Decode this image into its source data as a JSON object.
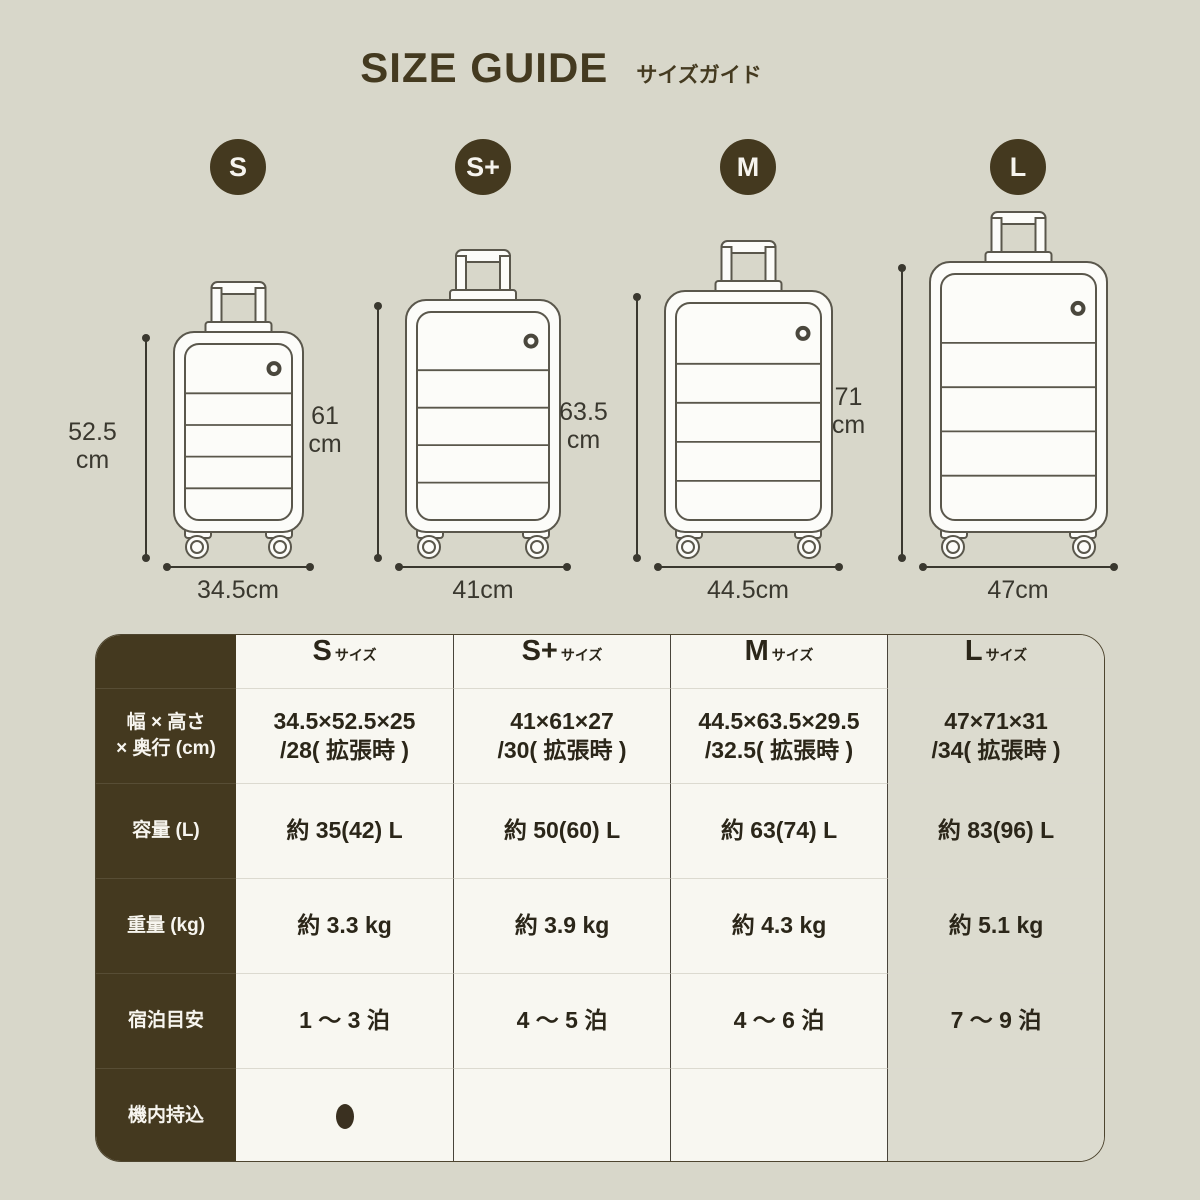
{
  "title": "SIZE GUIDE",
  "subtitle": "サイズガイド",
  "colors": {
    "background": "#d8d7ca",
    "accent_brown": "#44391f",
    "cell_white": "#f8f7f1",
    "cell_l_tint": "#dcdbcf",
    "line": "#3a382f"
  },
  "sizes": [
    {
      "badge": "S",
      "height_value": "52.5",
      "unit": "cm",
      "width_label": "34.5cm",
      "height_cm": 52.5,
      "width_cm": 34.5
    },
    {
      "badge": "S+",
      "height_value": "61",
      "unit": "cm",
      "width_label": "41cm",
      "height_cm": 61,
      "width_cm": 41
    },
    {
      "badge": "M",
      "height_value": "63.5",
      "unit": "cm",
      "width_label": "44.5cm",
      "height_cm": 63.5,
      "width_cm": 44.5
    },
    {
      "badge": "L",
      "height_value": "71",
      "unit": "cm",
      "width_label": "47cm",
      "height_cm": 71,
      "width_cm": 47
    }
  ],
  "table": {
    "header": {
      "cols": [
        {
          "size": "S",
          "suffix": "サイズ"
        },
        {
          "size": "S+",
          "suffix": "サイズ"
        },
        {
          "size": "M",
          "suffix": "サイズ"
        },
        {
          "size": "L",
          "suffix": "サイズ"
        }
      ]
    },
    "rows": [
      {
        "label": "幅 × 高さ",
        "label2": "× 奥行 (cm)",
        "values": [
          [
            "34.5×52.5×25",
            "/28( 拡張時 )"
          ],
          [
            "41×61×27",
            "/30( 拡張時 )"
          ],
          [
            "44.5×63.5×29.5",
            "/32.5( 拡張時 )"
          ],
          [
            "47×71×31",
            "/34( 拡張時 )"
          ]
        ]
      },
      {
        "label": "容量 (L)",
        "values": [
          "約 35(42) L",
          "約 50(60) L",
          "約 63(74) L",
          "約 83(96) L"
        ]
      },
      {
        "label": "重量 (kg)",
        "values": [
          "約 3.3 kg",
          "約 3.9 kg",
          "約 4.3 kg",
          "約 5.1 kg"
        ]
      },
      {
        "label": "宿泊目安",
        "values": [
          "1 〜 3 泊",
          "4 〜 5 泊",
          "4 〜 6 泊",
          "7 〜 9 泊"
        ]
      },
      {
        "label": "機内持込",
        "carry_on": {
          "S": true,
          "S+": false,
          "M": false,
          "L": false
        }
      }
    ]
  }
}
